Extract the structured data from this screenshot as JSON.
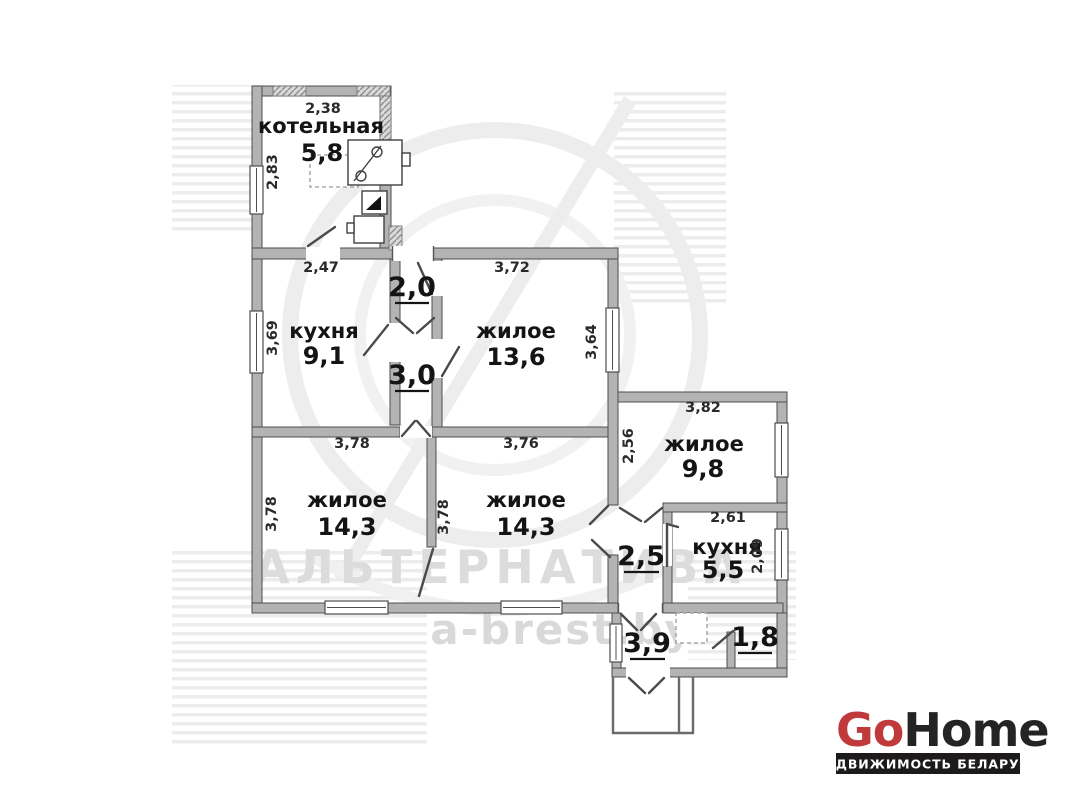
{
  "plan": {
    "wall_color": "#b3b3b3",
    "rooms": [
      {
        "name": "котельная",
        "area": "5,8"
      },
      {
        "name": "кухня",
        "area": "9,1"
      },
      {
        "name": "жилое",
        "area": "13,6"
      },
      {
        "name": "жилое",
        "area": "14,3"
      },
      {
        "name": "жилое",
        "area": "14,3"
      },
      {
        "name": "жилое",
        "area": "9,8"
      },
      {
        "name": "кухня",
        "area": "5,5"
      }
    ],
    "halls": [
      {
        "area": "2,0"
      },
      {
        "area": "3,0"
      },
      {
        "area": "2,5"
      },
      {
        "area": "3,9"
      },
      {
        "area": "1,8"
      }
    ],
    "dimensions": [
      {
        "value": "2,38"
      },
      {
        "value": "2,83"
      },
      {
        "value": "2,47"
      },
      {
        "value": "3,69"
      },
      {
        "value": "3,72"
      },
      {
        "value": "3,64"
      },
      {
        "value": "3,78"
      },
      {
        "value": "3,78"
      },
      {
        "value": "3,76"
      },
      {
        "value": "3,78"
      },
      {
        "value": "3,82"
      },
      {
        "value": "2,56"
      },
      {
        "value": "2,61"
      },
      {
        "value": "2,09"
      }
    ]
  },
  "watermark": {
    "brand": "АЛЬТЕРНАТИВА",
    "site": "a-brest.by"
  },
  "logo": {
    "go": "Go",
    "home": "Home",
    "tagline": "НЕДВИЖИМОСТЬ БЕЛАРУСИ",
    "go_color": "#c03a3c",
    "home_color": "#262324",
    "bar_color": "#1c1a1b"
  }
}
